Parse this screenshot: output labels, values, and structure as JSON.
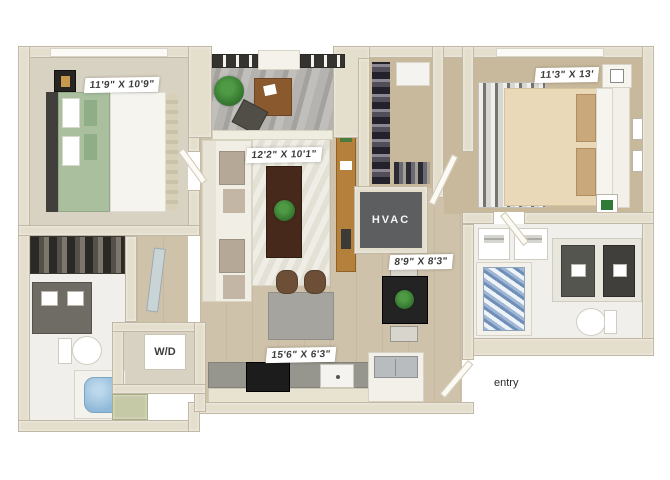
{
  "plan": {
    "type": "two-bedroom apartment 3D floor plan",
    "rooms": {
      "bedroom_left": {
        "dimensions": "11'9\" X 10'9\""
      },
      "living_room": {
        "dimensions": "12'2\" X 10'1\""
      },
      "bedroom_right": {
        "dimensions": "11'3\" X 13'"
      },
      "dining": {
        "dimensions": "8'9\" X 8'3\""
      },
      "kitchen": {
        "dimensions": "15'6\" X 6'3\""
      },
      "hvac_label": "HVAC",
      "washer_dryer_label": "W/D",
      "entry_label": "entry"
    },
    "colors": {
      "wall": "#e4decd",
      "wood_floor": "#cfc2ab",
      "carpet_light": "#d8d2c2",
      "carpet_tan": "#c9b99c",
      "bath_floor": "#f1efeb",
      "hvac_dark": "#5d5e60",
      "bed_green": "#a9bf9e",
      "bed_tan": "#e9d9b8",
      "water_blue": "#8fb9d8",
      "sage_accent": "#c6c9a6",
      "label_bg": "#ffffff",
      "label_text": "#3b3b3b"
    }
  }
}
